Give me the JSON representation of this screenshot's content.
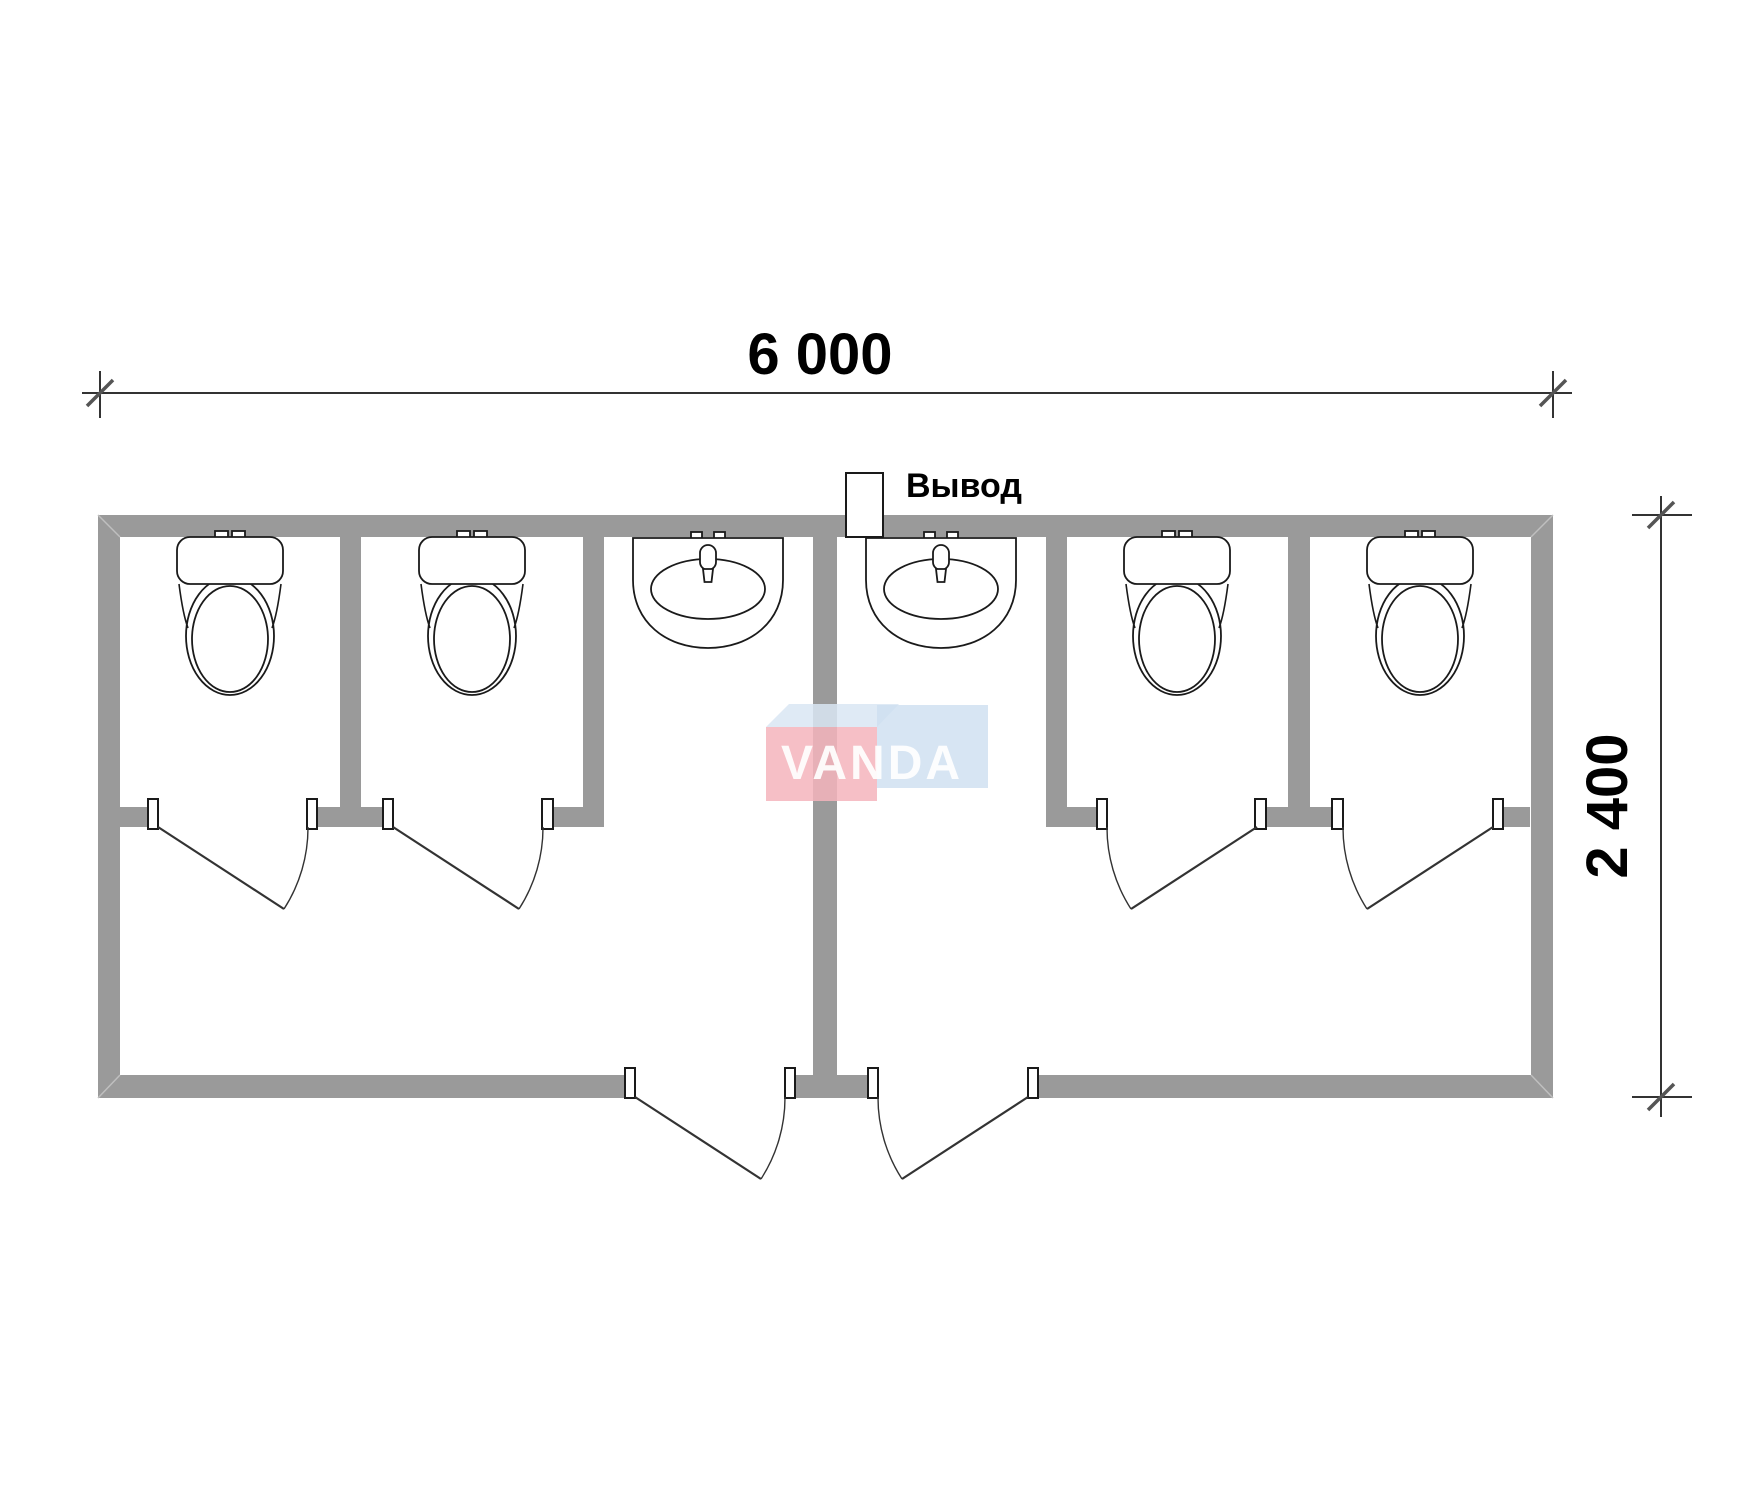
{
  "dimensions": {
    "width_label": "6 000",
    "height_label": "2 400"
  },
  "labels": {
    "outlet": "Вывод"
  },
  "watermark": {
    "text": "VANDA"
  },
  "fixtures": {
    "toilet_count": 4,
    "sink_count": 2,
    "stall_door_count": 4,
    "entrance_door_count": 2,
    "outlet_count": 1
  },
  "colors": {
    "background": "#ffffff",
    "wall": "#9a9a9a",
    "line": "#333333",
    "tick": "#555555",
    "fixture_stroke": "#1a1a1a",
    "logo_pink": "#f5b4bc",
    "logo_blue": "#cddff0",
    "logo_strip": "#d9e6f3",
    "logo_text": "#ffffff"
  }
}
